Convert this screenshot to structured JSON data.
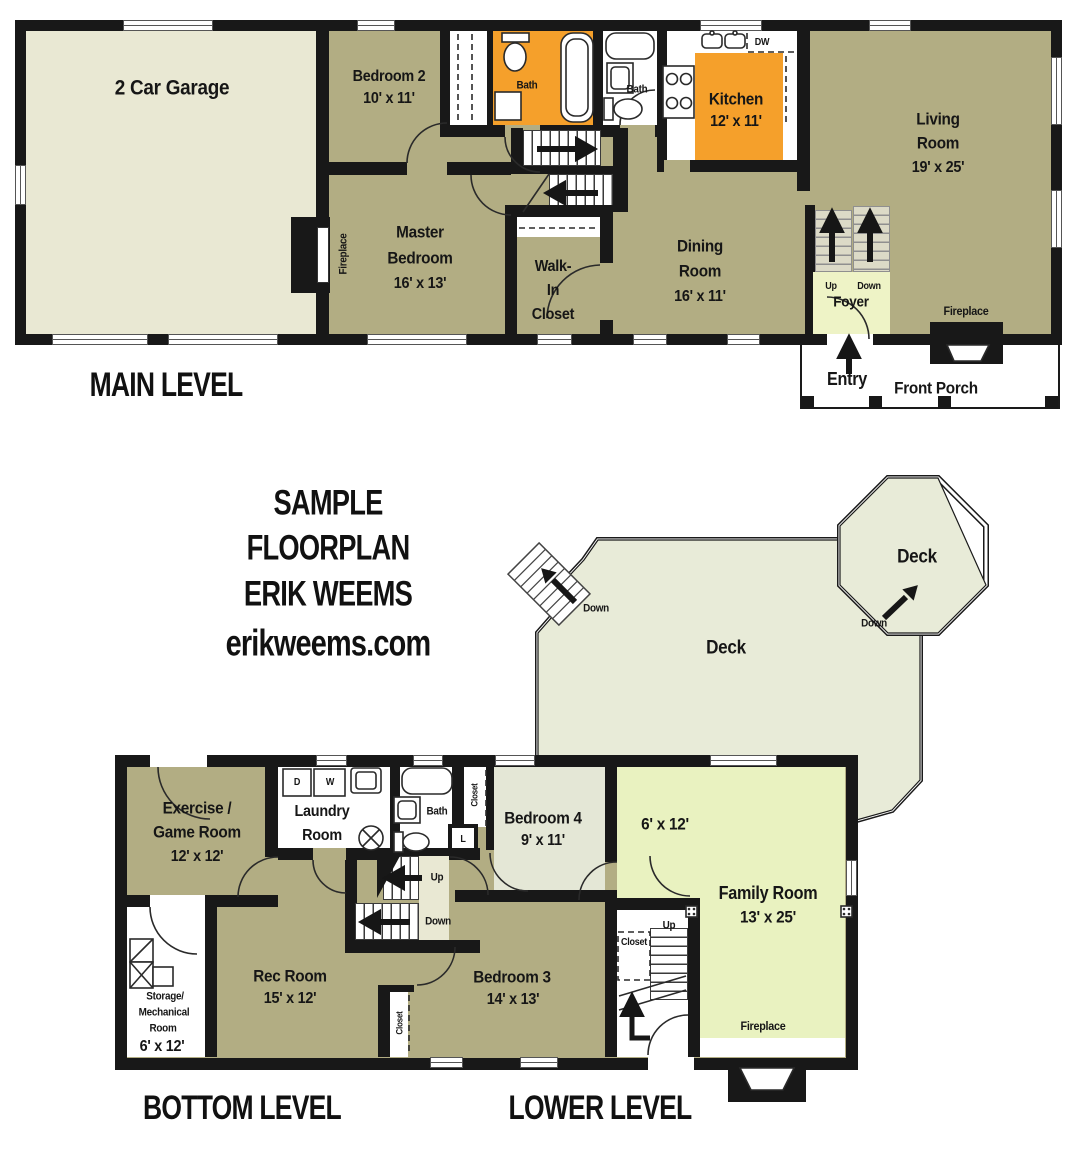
{
  "main": {
    "title": "MAIN LEVEL",
    "garage": "2 Car Garage",
    "bedroom2": {
      "name": "Bedroom 2",
      "dims": "10' x 11'"
    },
    "bath1": "Bath",
    "bath2": "Bath",
    "dw": "DW",
    "kitchen": {
      "name": "Kitchen",
      "dims": "12' x 11'"
    },
    "living": {
      "l1": "Living",
      "l2": "Room",
      "dims": "19' x 25'"
    },
    "master": {
      "l1": "Master",
      "l2": "Bedroom",
      "dims": "16' x 13'"
    },
    "walkin": {
      "l1": "Walk-",
      "l2": "In",
      "l3": "Closet"
    },
    "dining": {
      "l1": "Dining",
      "l2": "Room",
      "dims": "16' x 11'"
    },
    "fp_master": "Fireplace",
    "fp_living": "Fireplace",
    "foyer": {
      "up": "Up",
      "down": "Down",
      "name": "Foyer"
    },
    "entry": "Entry",
    "porch": "Front Porch"
  },
  "brand": {
    "l1": "SAMPLE",
    "l2": "FLOORPLAN",
    "l3": "ERIK WEEMS",
    "l4": "erikweems.com"
  },
  "deck": {
    "main": "Deck",
    "octagon": "Deck",
    "down1": "Down",
    "down2": "Down"
  },
  "lower": {
    "title_bottom": "BOTTOM LEVEL",
    "title_lower": "LOWER LEVEL",
    "exercise": {
      "l1": "Exercise /",
      "l2": "Game Room",
      "dims": "12' x 12'"
    },
    "laundry": {
      "l1": "Laundry",
      "l2": "Room",
      "d": "D",
      "w": "W"
    },
    "bath": "Bath",
    "closet_top": "Closet",
    "linen": "L",
    "bedroom4": {
      "name": "Bedroom 4",
      "dims": "9' x 11'"
    },
    "nook": "6' x 12'",
    "family": {
      "name": "Family Room",
      "dims": "13' x 25'",
      "fireplace": "Fireplace"
    },
    "mid": {
      "up": "Up",
      "down": "Down"
    },
    "rec": {
      "name": "Rec Room",
      "dims": "15' x 12'"
    },
    "storage": {
      "l1": "Storage/",
      "l2": "Mechanical",
      "l3": "Room",
      "dims": "6' x 12'"
    },
    "closet_rec": "Closet",
    "right": {
      "closet": "Closet",
      "up": "Up"
    },
    "bedroom3": {
      "name": "Bedroom 3",
      "dims": "14' x 13'"
    }
  },
  "colors": {
    "wall": "#181818",
    "olive": "#b2ad83",
    "cream": "#e9e8d3",
    "orange": "#f5a02b",
    "light_green": "#e9f2c0",
    "foyer_green": "#eef3c6",
    "deck": "#e8ebd8",
    "pale": "#e4e7d6"
  }
}
